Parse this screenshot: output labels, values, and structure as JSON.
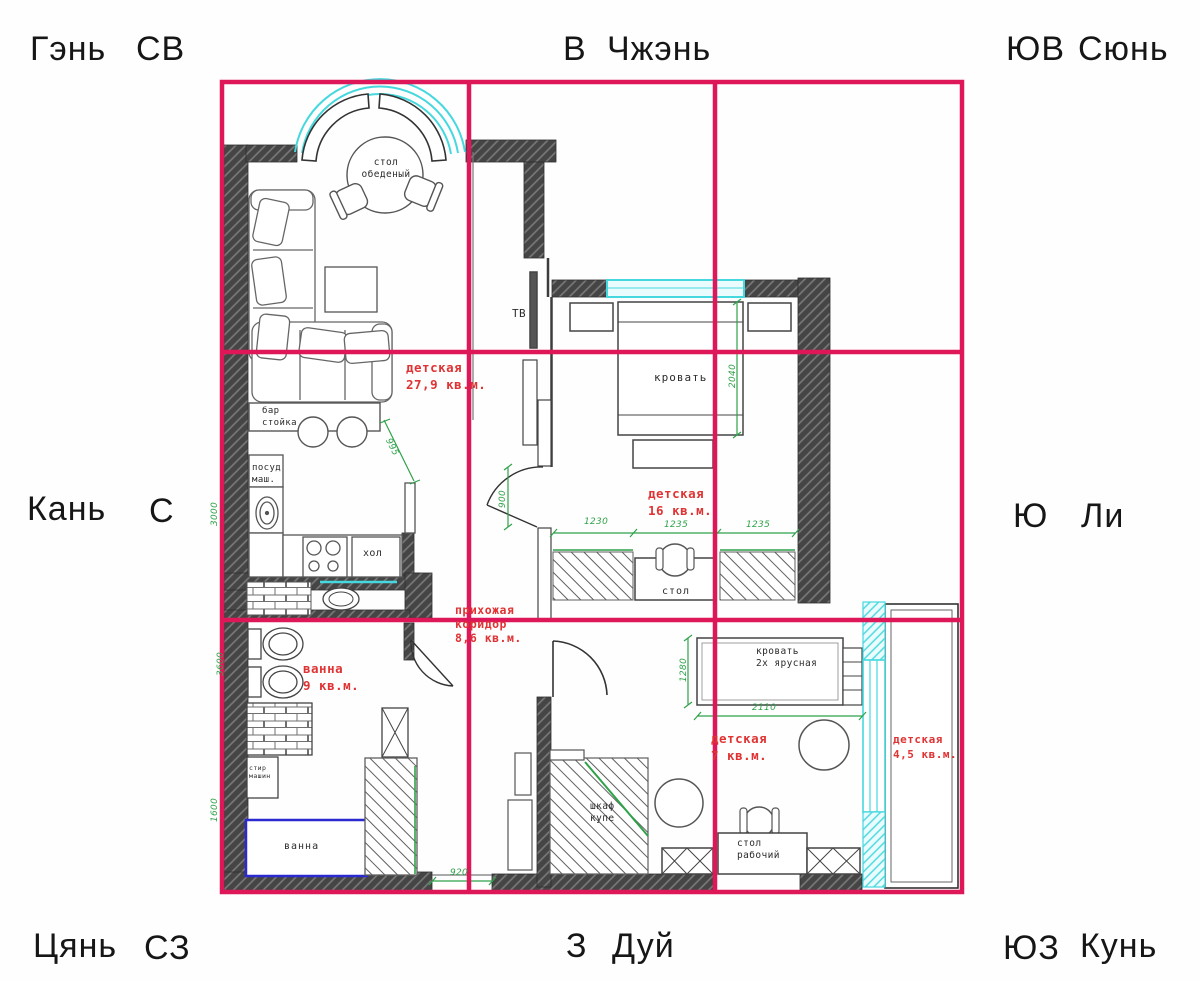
{
  "bagua": {
    "gen": "Гэнь",
    "sv": "СВ",
    "v": "В",
    "zhen": "Чжэнь",
    "yuv": "ЮВ",
    "xun": "Сюнь",
    "kan": "Кань",
    "s": "С",
    "yu": "Ю",
    "li": "Ли",
    "qian": "Цянь",
    "sz": "СЗ",
    "z": "З",
    "dui": "Дуй",
    "yuz": "ЮЗ",
    "kun": "Кунь"
  },
  "rooms": {
    "living": "детская\n27,9 кв.м.",
    "bedroom": "детская\n16 кв.м.",
    "hallway": "прихожая\nкоридор\n8,6 кв.м.",
    "bathroom": "ванна\n9 кв.м.",
    "kids": "детская\n7 кв.м.",
    "balcony": "детская\n4,5 кв.м."
  },
  "furniture": {
    "dining_table": "стол\nобеденый",
    "tv": "ТВ",
    "bed": "кровать",
    "bar": "бар\nстойка",
    "dishwasher": "посуд\nмаш.",
    "fridge": "хол",
    "desk": "стол",
    "bunk_bed": "кровать\n2х ярусная",
    "wardrobe": "шкаф\nкупе",
    "work_desk": "стол\nрабочий",
    "washer": "стир\nмашин",
    "bathtub": "ванна"
  },
  "dimensions": {
    "d995": "995",
    "d900": "900",
    "d920": "920",
    "d1230": "1230",
    "d1235a": "1235",
    "d1235b": "1235",
    "d2040": "2040",
    "d1280": "1280",
    "d2110": "2110",
    "d3000": "3000",
    "d3600": "3600",
    "d1600": "1600"
  },
  "colors": {
    "grid": "#dd1758",
    "window": "#45d8de",
    "dimension": "#2fa24a",
    "room_label": "#e03434",
    "wall": "#454545",
    "bathtub_outline": "#2a2ad0"
  }
}
